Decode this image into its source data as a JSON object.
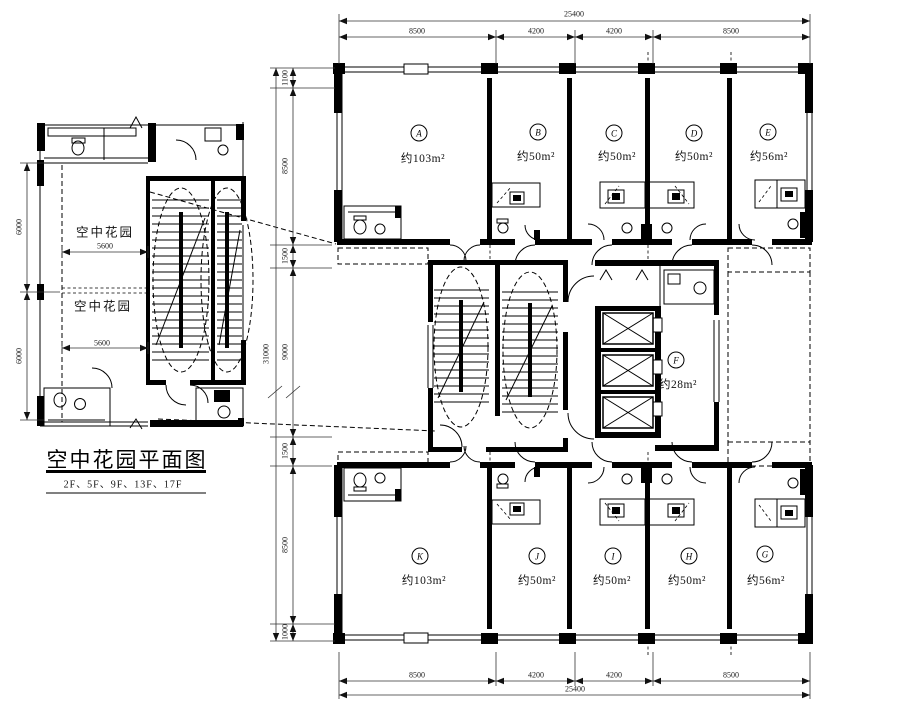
{
  "drawing": {
    "title_block": {
      "title": "空中花园平面图",
      "floors": "2F、5F、9F、13F、17F"
    },
    "detail_plan": {
      "room1_label": "空中花园",
      "room1_width": "5600",
      "room2_label": "空中花园",
      "room2_width": "5600",
      "height_dims": [
        "6000",
        "6000"
      ]
    },
    "main_plan": {
      "dims": {
        "top_total": "25400",
        "top_segments": [
          "8500",
          "4200",
          "4200",
          "8500"
        ],
        "bottom_segments": [
          "8500",
          "4200",
          "4200",
          "8500"
        ],
        "bottom_total": "25400",
        "left_total": "31000",
        "left_segments": [
          "1100",
          "8500",
          "1500",
          "9000",
          "1500",
          "8500",
          "1000"
        ]
      },
      "units_top": [
        {
          "tag": "A",
          "area": "约103m²"
        },
        {
          "tag": "B",
          "area": "约50m²"
        },
        {
          "tag": "C",
          "area": "约50m²"
        },
        {
          "tag": "D",
          "area": "约50m²"
        },
        {
          "tag": "E",
          "area": "约56m²"
        }
      ],
      "unit_middle": {
        "tag": "F",
        "area": "约28m²"
      },
      "units_bottom": [
        {
          "tag": "K",
          "area": "约103m²"
        },
        {
          "tag": "J",
          "area": "约50m²"
        },
        {
          "tag": "I",
          "area": "约50m²"
        },
        {
          "tag": "H",
          "area": "约50m²"
        },
        {
          "tag": "G",
          "area": "约56m²"
        }
      ]
    }
  }
}
